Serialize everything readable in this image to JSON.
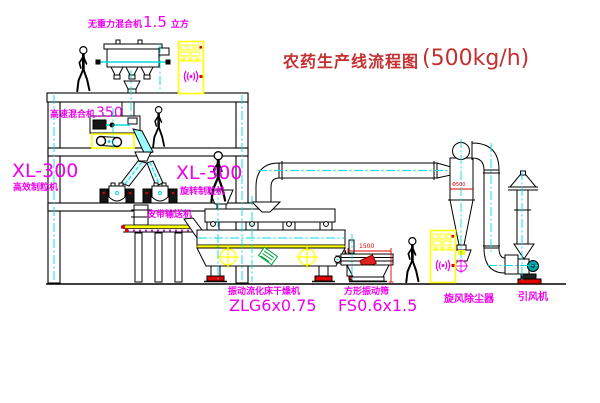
{
  "title": {
    "text": "农药生产线流程图",
    "capacity": "(500kg/h)"
  },
  "labels": {
    "gravity_mixer": {
      "name": "无重力混合机",
      "capacity": "1.5",
      "unit": "立方"
    },
    "high_speed_mixer": {
      "name": "高速混合机",
      "model": "350"
    },
    "granulator_left": {
      "model": "XL-300",
      "name": "高效制粒机"
    },
    "granulator_right": {
      "model": "XL-300",
      "name": "旋转制粒机"
    },
    "belt_conveyor": {
      "name": "皮带输送机"
    },
    "fluid_bed_dryer": {
      "name": "振动流化床干燥机",
      "model": "ZLG6x0.75"
    },
    "vibrating_screen": {
      "name": "方形振动筛",
      "model": "FS0.6x1.5"
    },
    "cyclone": {
      "name": "旋风除尘器"
    },
    "induced_fan": {
      "name": "引风机"
    }
  },
  "dimensions": {
    "screen_length": "1500",
    "cyclone_diameter": "Φ500"
  },
  "colors": {
    "line": "#000000",
    "centerline_cyan": "#00dede",
    "label_magenta": "#ee00ee",
    "title_red": "#c43030",
    "dimension_red": "#e00000",
    "cabinet_yellow": "#ffff00",
    "motor_teal": "#00a6a6",
    "tag_green": "#00a040"
  }
}
